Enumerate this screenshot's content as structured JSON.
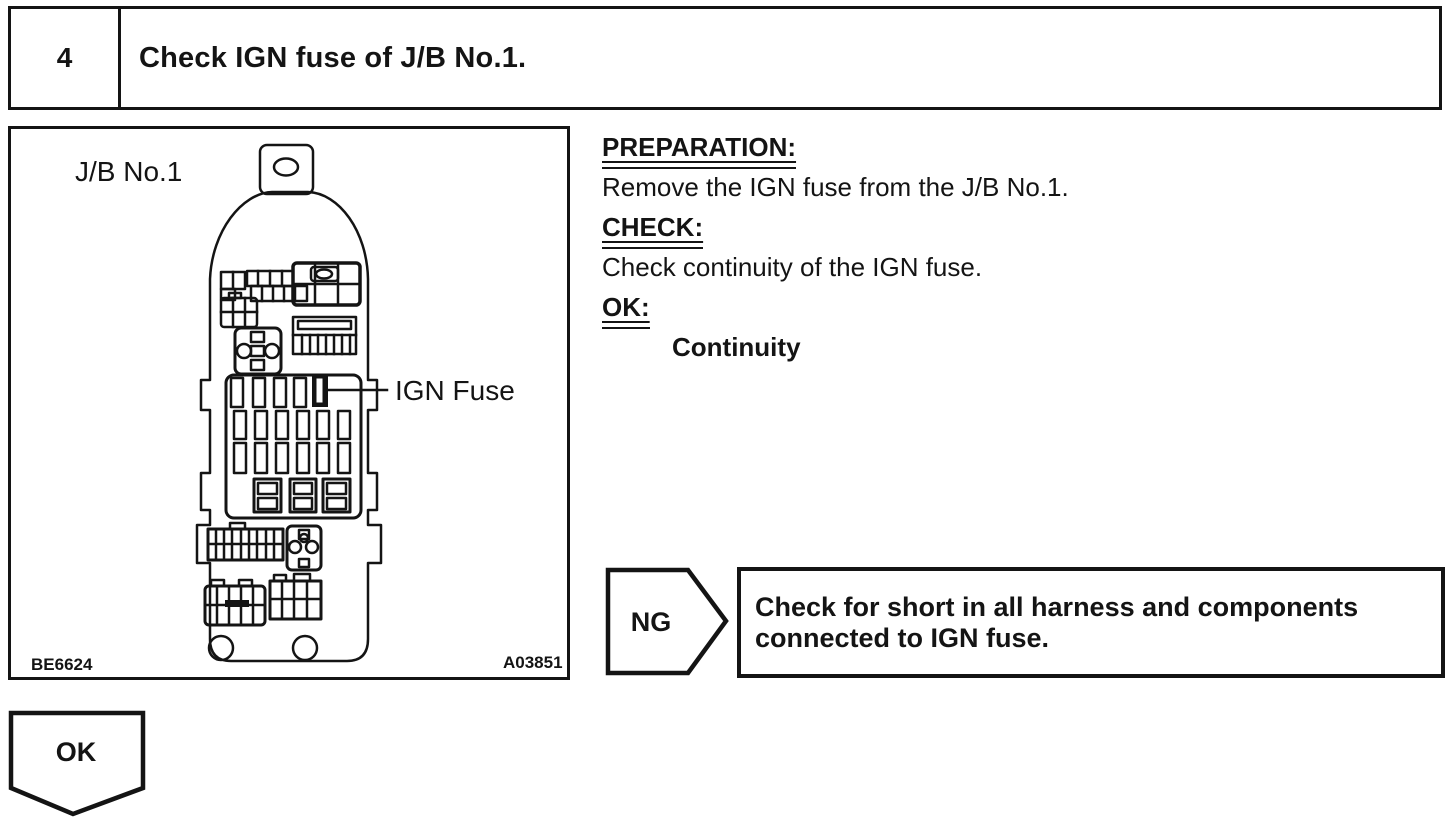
{
  "step": {
    "number": "4",
    "title": "Check IGN fuse of J/B No.1."
  },
  "figure": {
    "jb_label": "J/B No.1",
    "ign_label": "IGN Fuse",
    "code_left": "BE6624",
    "code_right": "A03851"
  },
  "instructions": {
    "preparation_heading": "PREPARATION:",
    "preparation_body": "Remove the IGN fuse from the J/B No.1.",
    "check_heading": "CHECK:",
    "check_body": "Check continuity of the IGN fuse.",
    "ok_heading": "OK:",
    "ok_result": "Continuity"
  },
  "ng": {
    "label": "NG",
    "line1": "Check for short in all harness and components",
    "line2": "connected to IGN fuse."
  },
  "ok": {
    "label": "OK"
  },
  "colors": {
    "ink": "#141414",
    "paper": "#ffffff"
  }
}
